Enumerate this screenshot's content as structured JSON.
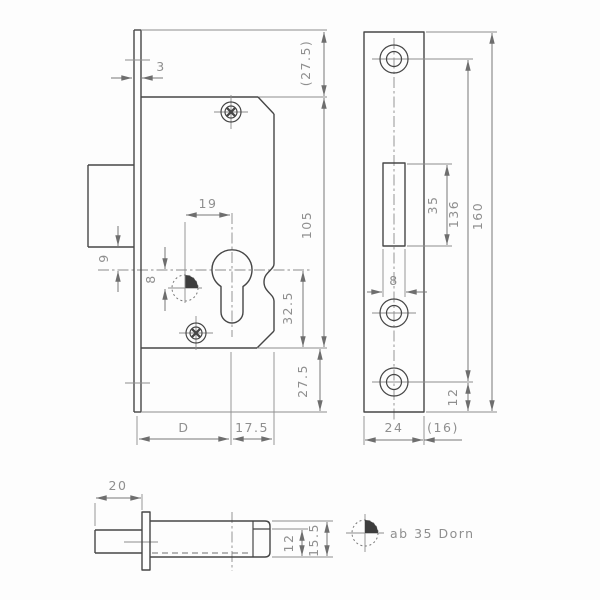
{
  "meta": {
    "type": "technical-drawing",
    "subject": "mortise lock with euro profile cylinder"
  },
  "colors": {
    "background": "#fdfdfd",
    "outline": "#464646",
    "dimension_text": "#8f8f8f"
  },
  "left_view": {
    "dims": {
      "faceplate_thickness": "3",
      "top_clearance": "(27.5)",
      "case_height": "105",
      "center_to_pin": "19",
      "bolt_to_center": "9",
      "pin_offset": "8",
      "center_to_case_bottom": "32.5",
      "case_to_plate_bottom": "27.5",
      "backset": "D",
      "center_to_case_edge": "17.5"
    }
  },
  "plate_view": {
    "dims": {
      "cutout_height": "35",
      "hole_spacing": "136",
      "plate_height": "160",
      "cutout_width": "8",
      "hole_to_bottom": "12",
      "plate_width": "24",
      "plate_side": "(16)"
    }
  },
  "bolt_view": {
    "dims": {
      "bolt_throw": "20",
      "bolt_height": "12",
      "case_thickness": "15.5"
    }
  },
  "legend": {
    "note": "ab 35 Dorn"
  }
}
